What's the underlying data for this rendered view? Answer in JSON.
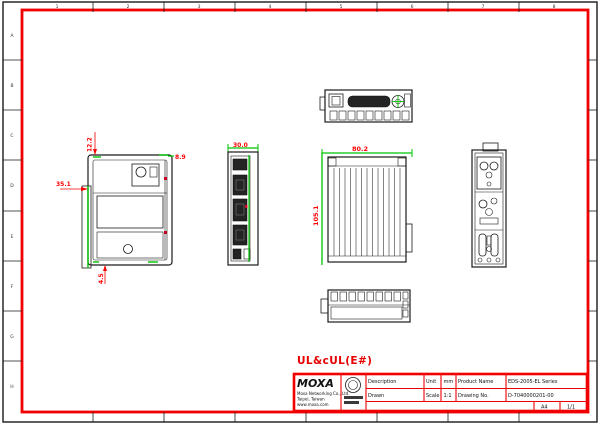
{
  "colors": {
    "frame": "#f00000",
    "line": "#1a1a1a",
    "highlight": "#00c300",
    "dimension": "#ff0000"
  },
  "zones": {
    "cols": [
      "1",
      "2",
      "3",
      "4",
      "5",
      "6",
      "7",
      "8"
    ],
    "rows": [
      "A",
      "B",
      "C",
      "D",
      "E",
      "F",
      "G",
      "H"
    ]
  },
  "ul_note": "UL&cUL(E#)",
  "dims": {
    "rear_top": "12.2",
    "rear_left": "35.1",
    "rear_bottom": "4.5",
    "rear_right": "8.9",
    "front_width": "30.0",
    "side_width": "80.2",
    "side_height": "105.1"
  },
  "title_block": {
    "logo": "MOXA",
    "logo_line1": "Moxa Networking Co., Ltd.",
    "logo_line2": "Taipei, Taiwan",
    "logo_line3": "www.moxa.com",
    "desc_label": "Description",
    "unit_label": "Unit",
    "unit_value": "mm",
    "product_label": "Product Name",
    "product_value": "EDS-2005-EL Series",
    "drawn_label": "Drawn",
    "scale_label": "Scale",
    "scale_value": "1:1",
    "drawing_no_label": "Drawing No.",
    "drawing_no_value": "D-7040000201-00",
    "size_value": "A4",
    "sheet_value": "1/1"
  }
}
